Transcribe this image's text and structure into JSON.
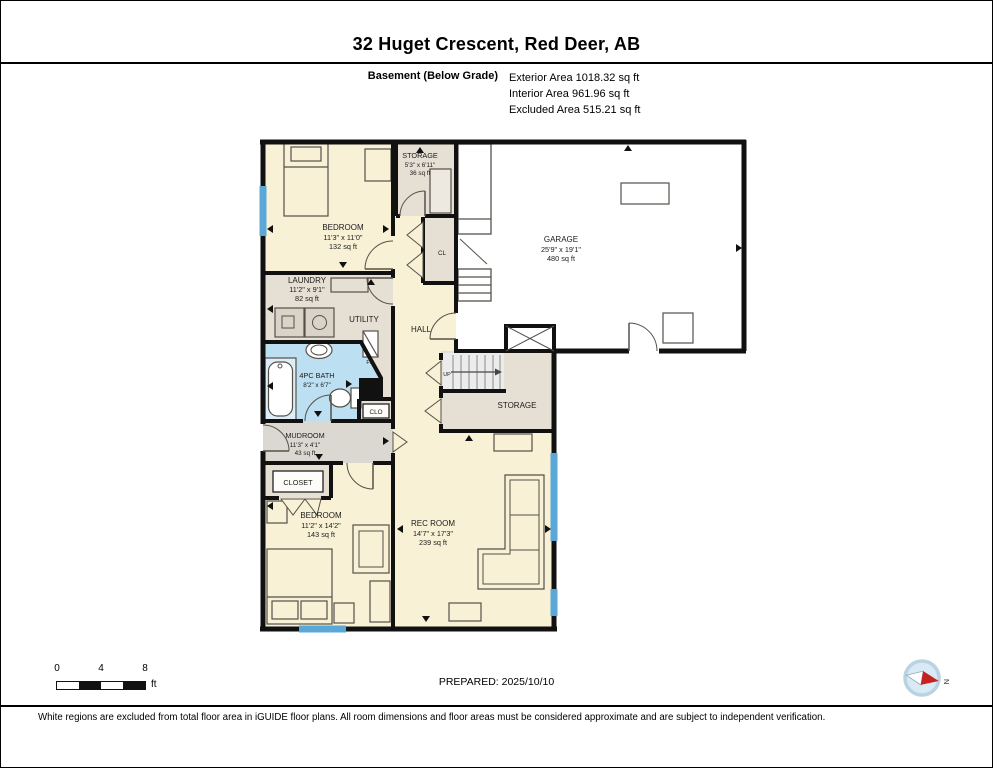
{
  "header": {
    "title": "32 Huget Crescent, Red Deer, AB",
    "floor_label": "Basement (Below Grade)",
    "exterior_area": "Exterior Area 1018.32 sq ft",
    "interior_area": "Interior Area 961.96 sq ft",
    "excluded_area": "Excluded Area 515.21 sq ft"
  },
  "rooms": {
    "bedroom_top": {
      "name": "BEDROOM",
      "dims": "11'3\" x 11'0\"",
      "area": "132 sq ft"
    },
    "storage_top": {
      "name": "STORAGE",
      "dims": "5'3\" x 6'11\"",
      "area": "36 sq ft"
    },
    "garage": {
      "name": "GARAGE",
      "dims": "25'9\" x 19'1\"",
      "area": "480 sq ft"
    },
    "laundry": {
      "name": "LAUNDRY",
      "dims": "11'2\" x 9'1\"",
      "area": "82 sq ft"
    },
    "utility": {
      "name": "UTILITY"
    },
    "hall": {
      "name": "HALL"
    },
    "closet_cl": {
      "name": "CL"
    },
    "bath": {
      "name": "4PC BATH",
      "dims": "8'2\" x 6'7\""
    },
    "closet_clo": {
      "name": "CLO"
    },
    "mudroom": {
      "name": "MUDROOM",
      "dims": "11'3\" x 4'1\"",
      "area": "43 sq ft"
    },
    "closet": {
      "name": "CLOSET"
    },
    "bedroom_bottom": {
      "name": "BEDROOM",
      "dims": "11'2\" x 14'2\"",
      "area": "143 sq ft"
    },
    "rec_room": {
      "name": "REC ROOM",
      "dims": "14'7\" x 17'3\"",
      "area": "239 sq ft"
    },
    "storage_mid": {
      "name": "STORAGE"
    }
  },
  "annotations": {
    "up": "UP",
    "furnace": "FN"
  },
  "footer": {
    "scale_ticks": [
      "0",
      "4",
      "8"
    ],
    "scale_unit": "ft",
    "prepared": "PREPARED: 2025/10/10",
    "compass_north": "N",
    "disclaimer": "White regions are excluded from total floor area in iGUIDE floor plans. All room dimensions and floor areas must be considered approximate and are subject to independent verification."
  },
  "colors": {
    "room_cream": "#f8f1d6",
    "room_taupe": "#e6dfd3",
    "room_gray": "#dbd8d2",
    "bath_blue": "#bce0f1",
    "window_blue": "#5aa8d8",
    "wall": "#111111"
  }
}
